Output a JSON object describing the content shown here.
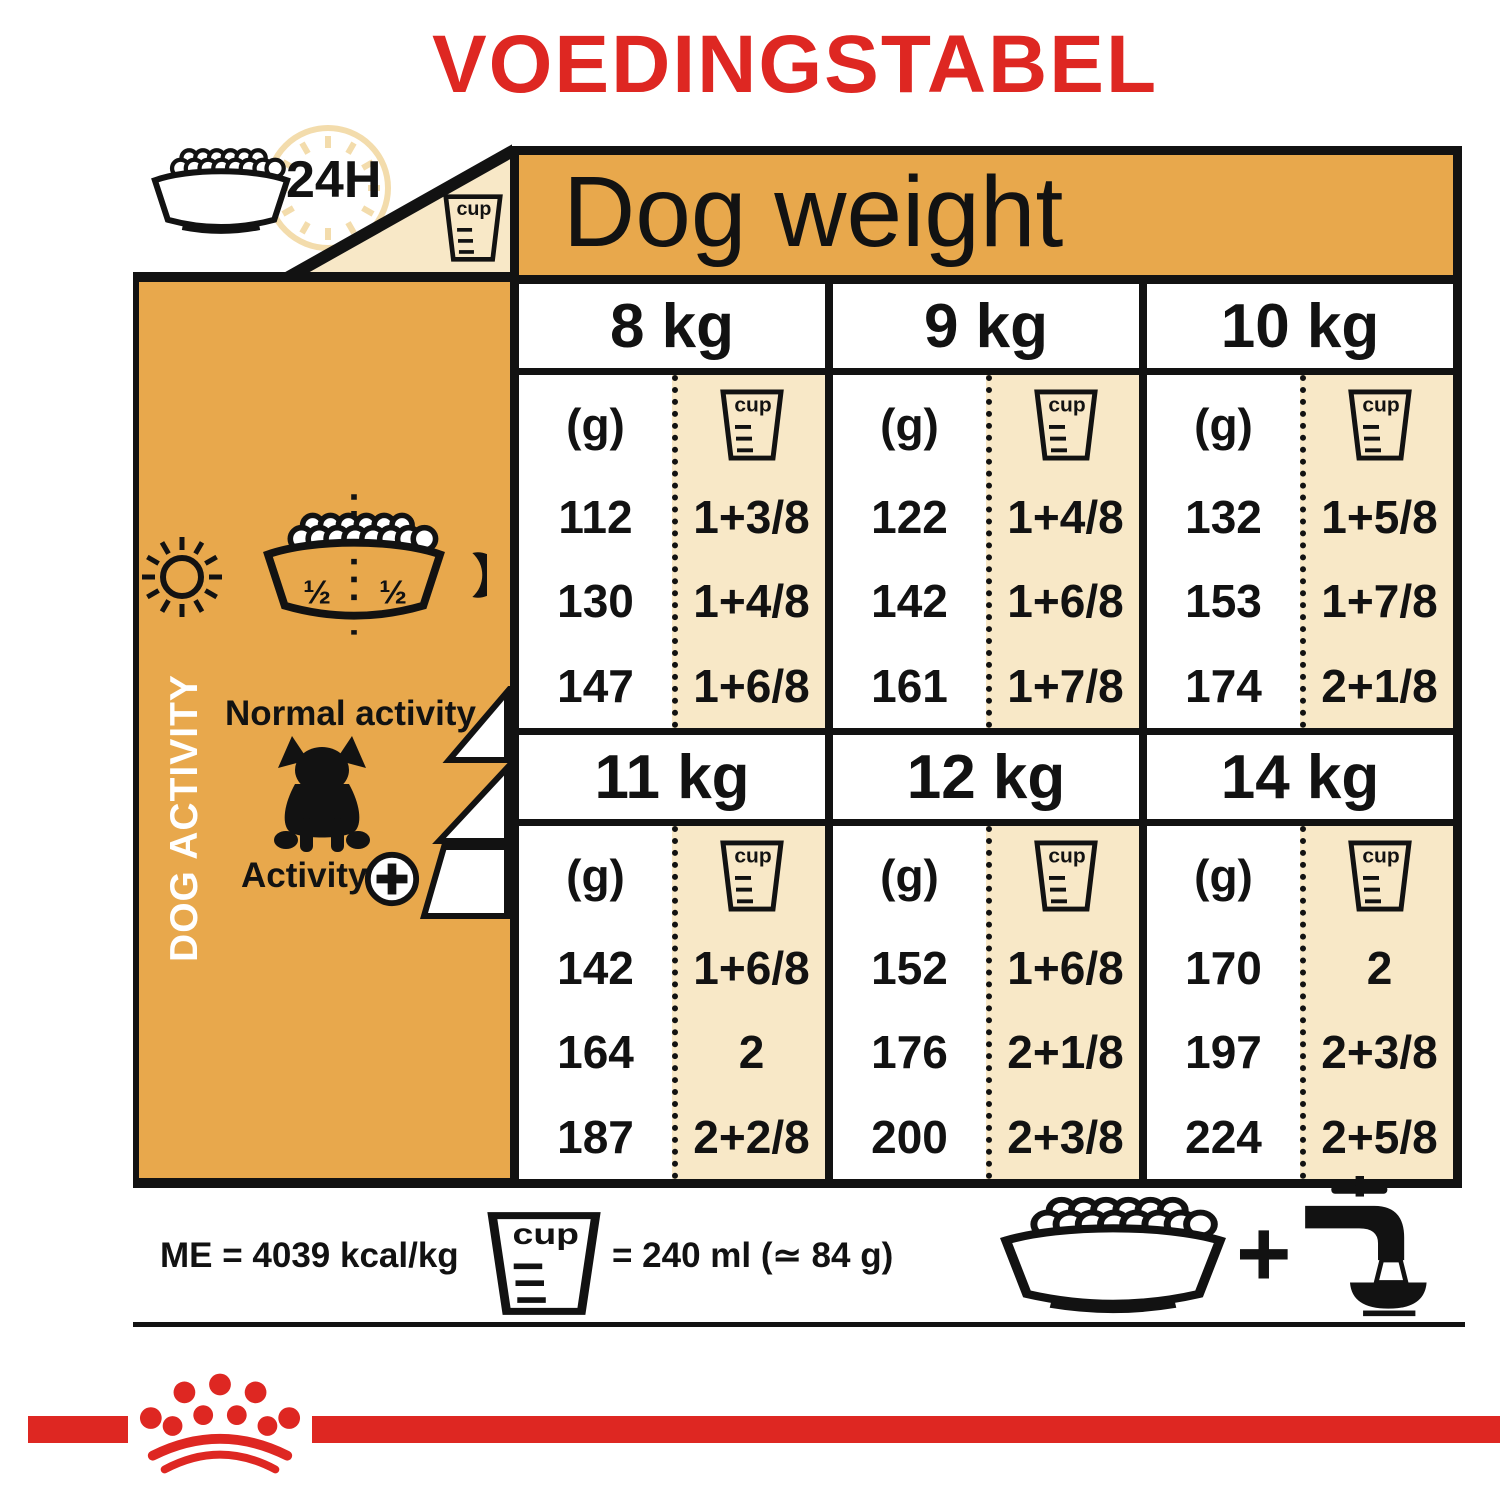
{
  "title": "VOEDINGSTABEL",
  "top": {
    "time_label": "24H",
    "cup_label": "cup"
  },
  "sidebar": {
    "vertical_label": "DOG ACTIVITY",
    "bowl_left_half": "½",
    "bowl_right_half": "½",
    "normal_activity_label": "Normal activity",
    "activity_label": "Activity",
    "activity_plus": "+"
  },
  "table": {
    "title": "Dog weight",
    "grams_header": "(g)",
    "cup_label": "cup",
    "banks": [
      {
        "columns": [
          {
            "weight": "8 kg",
            "grams": [
              "112",
              "130",
              "147"
            ],
            "cups": [
              "1+3/8",
              "1+4/8",
              "1+6/8"
            ]
          },
          {
            "weight": "9 kg",
            "grams": [
              "122",
              "142",
              "161"
            ],
            "cups": [
              "1+4/8",
              "1+6/8",
              "1+7/8"
            ]
          },
          {
            "weight": "10 kg",
            "grams": [
              "132",
              "153",
              "174"
            ],
            "cups": [
              "1+5/8",
              "1+7/8",
              "2+1/8"
            ]
          }
        ]
      },
      {
        "columns": [
          {
            "weight": "11 kg",
            "grams": [
              "142",
              "164",
              "187"
            ],
            "cups": [
              "1+6/8",
              "2",
              "2+2/8"
            ]
          },
          {
            "weight": "12 kg",
            "grams": [
              "152",
              "176",
              "200"
            ],
            "cups": [
              "1+6/8",
              "2+1/8",
              "2+3/8"
            ]
          },
          {
            "weight": "14 kg",
            "grams": [
              "170",
              "197",
              "224"
            ],
            "cups": [
              "2",
              "2+3/8",
              "2+5/8"
            ]
          }
        ]
      }
    ]
  },
  "footer": {
    "energy_label": "ME = 4039 kcal/kg",
    "cup_label": "cup",
    "cup_equivalence": "= 240 ml (≃ 84 g)",
    "plus": "+"
  },
  "colors": {
    "accent_red": "#DE2722",
    "panel_orange": "#E8A84C",
    "cup_column_cream": "#F8E8C7",
    "clock_cream": "#F3DCAC",
    "ink_black": "#121212"
  }
}
